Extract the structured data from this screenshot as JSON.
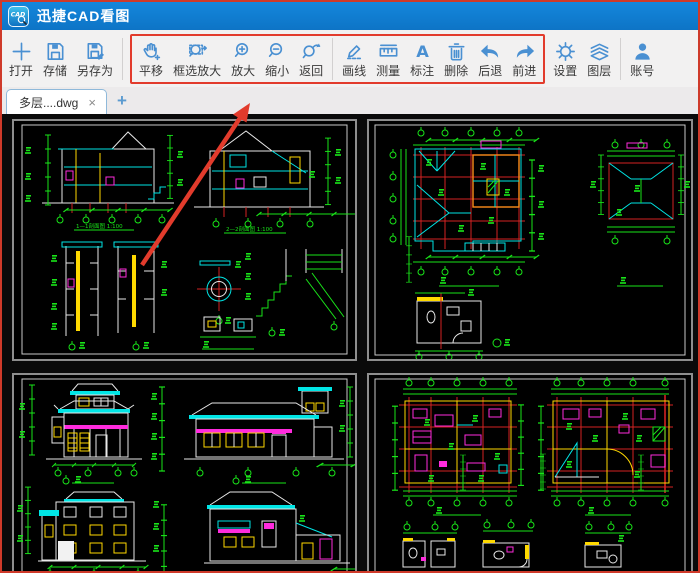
{
  "window": {
    "title": "迅捷CAD看图"
  },
  "toolbar": {
    "open": "打开",
    "save": "存储",
    "save_as": "另存为",
    "pan": "平移",
    "marquee_zoom": "框选放大",
    "zoom_in": "放大",
    "zoom_out": "缩小",
    "back": "返回",
    "draw_line": "画线",
    "measure": "测量",
    "annotate": "标注",
    "delete": "删除",
    "undo": "后退",
    "redo": "前进",
    "settings": "设置",
    "layers": "图层",
    "account": "账号",
    "annotate_glyph": "A"
  },
  "tabbar": {
    "active_tab": "多层....dwg",
    "close": "×",
    "new_tab": "+"
  },
  "canvas": {
    "captions": {
      "section_left": "1—1剖面图 1:100",
      "section_right": "2—2剖面图 1:100"
    }
  },
  "colors": {
    "titlebar_blue": "#1081d6",
    "icon_blue": "#4a90d2",
    "highlight_red": "#e23b2c",
    "cad_green": "#19e519",
    "cad_cyan": "#00e5e5",
    "cad_yellow": "#ffd900",
    "cad_magenta": "#ff2bdd",
    "cad_red": "#d42222",
    "cad_orange": "#ff8c1a"
  }
}
